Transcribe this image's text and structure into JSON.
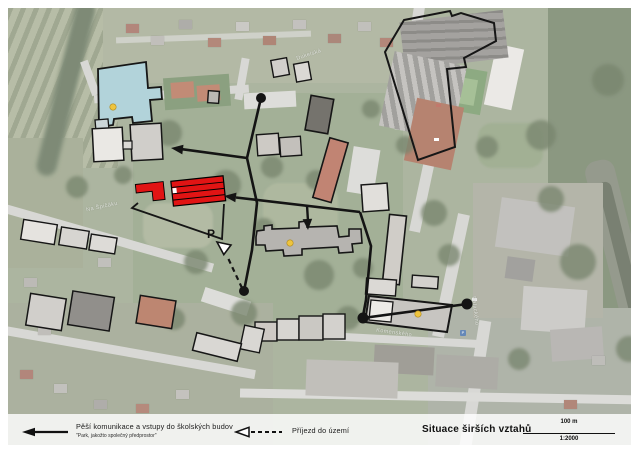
{
  "legend": {
    "pedestrian": {
      "label": "Pěší komunikace a vstupy do školských budov",
      "note": "\"Park, jakožto společný předprostor\""
    },
    "approach": {
      "label": "Příjezd do území"
    },
    "title": "Situace širších vztahů",
    "scale_distance": "100 m",
    "scale_ratio": "1:2000"
  },
  "map": {
    "parking_label": "P",
    "street_labels": [
      {
        "text": "Na Špičáku"
      },
      {
        "text": "Dukelská"
      },
      {
        "text": "Palackého"
      },
      {
        "text": "Komenského"
      }
    ]
  }
}
